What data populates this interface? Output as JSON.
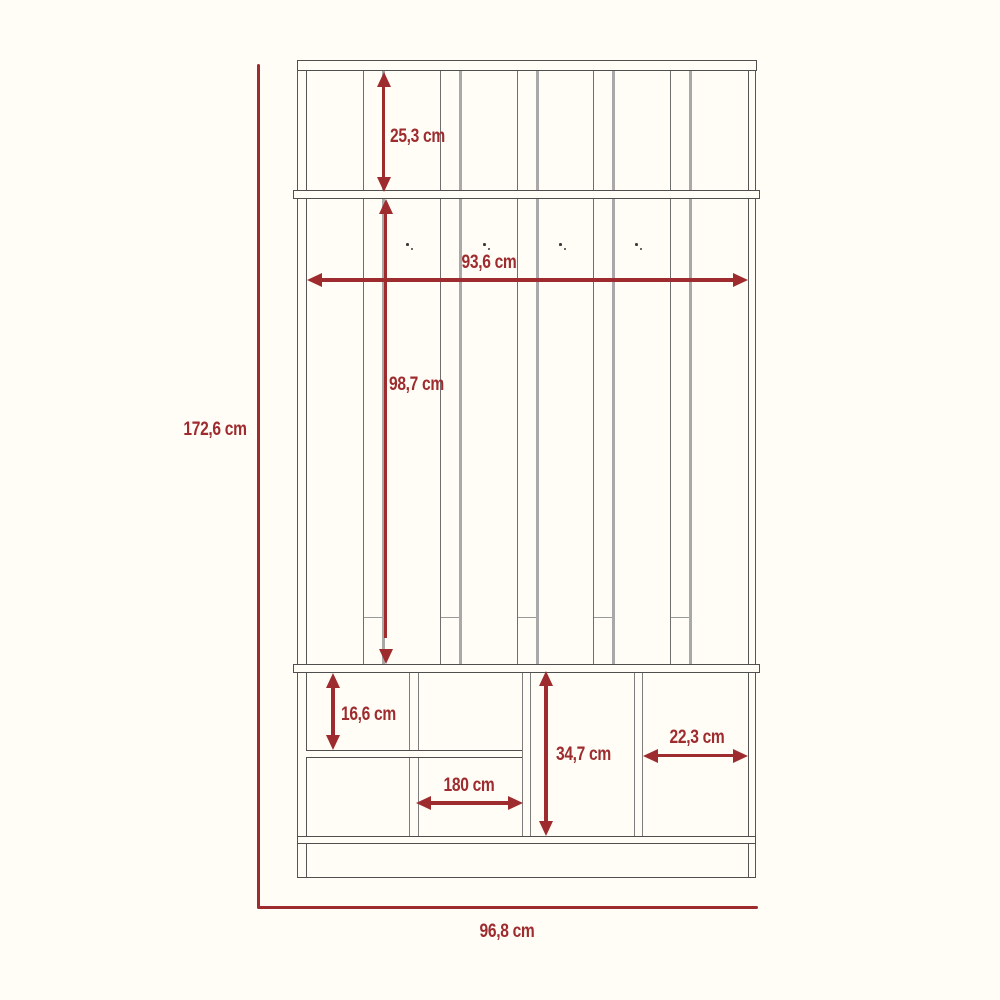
{
  "diagram": {
    "type": "furniture dimension drawing",
    "subject": "hall tree coat rack with cubby storage",
    "unit": "cm",
    "hook_count": 4,
    "slat_count": 5
  },
  "colors": {
    "accent": "#9e2c2f",
    "frame": "#4f4f4f",
    "slat_line": "#a9a9a9",
    "background": "#fffdf6"
  },
  "dimensions": {
    "overall_height": "172,6 cm",
    "overall_width": "96,8 cm",
    "top_section_height": "25,3 cm",
    "middle_section_height": "98,7 cm",
    "interior_width": "93,6 cm",
    "upper_cubby_height": "16,6 cm",
    "lower_section_height": "34,7 cm",
    "right_cubby_width": "22,3 cm",
    "center_cubby_width": "180 cm"
  }
}
